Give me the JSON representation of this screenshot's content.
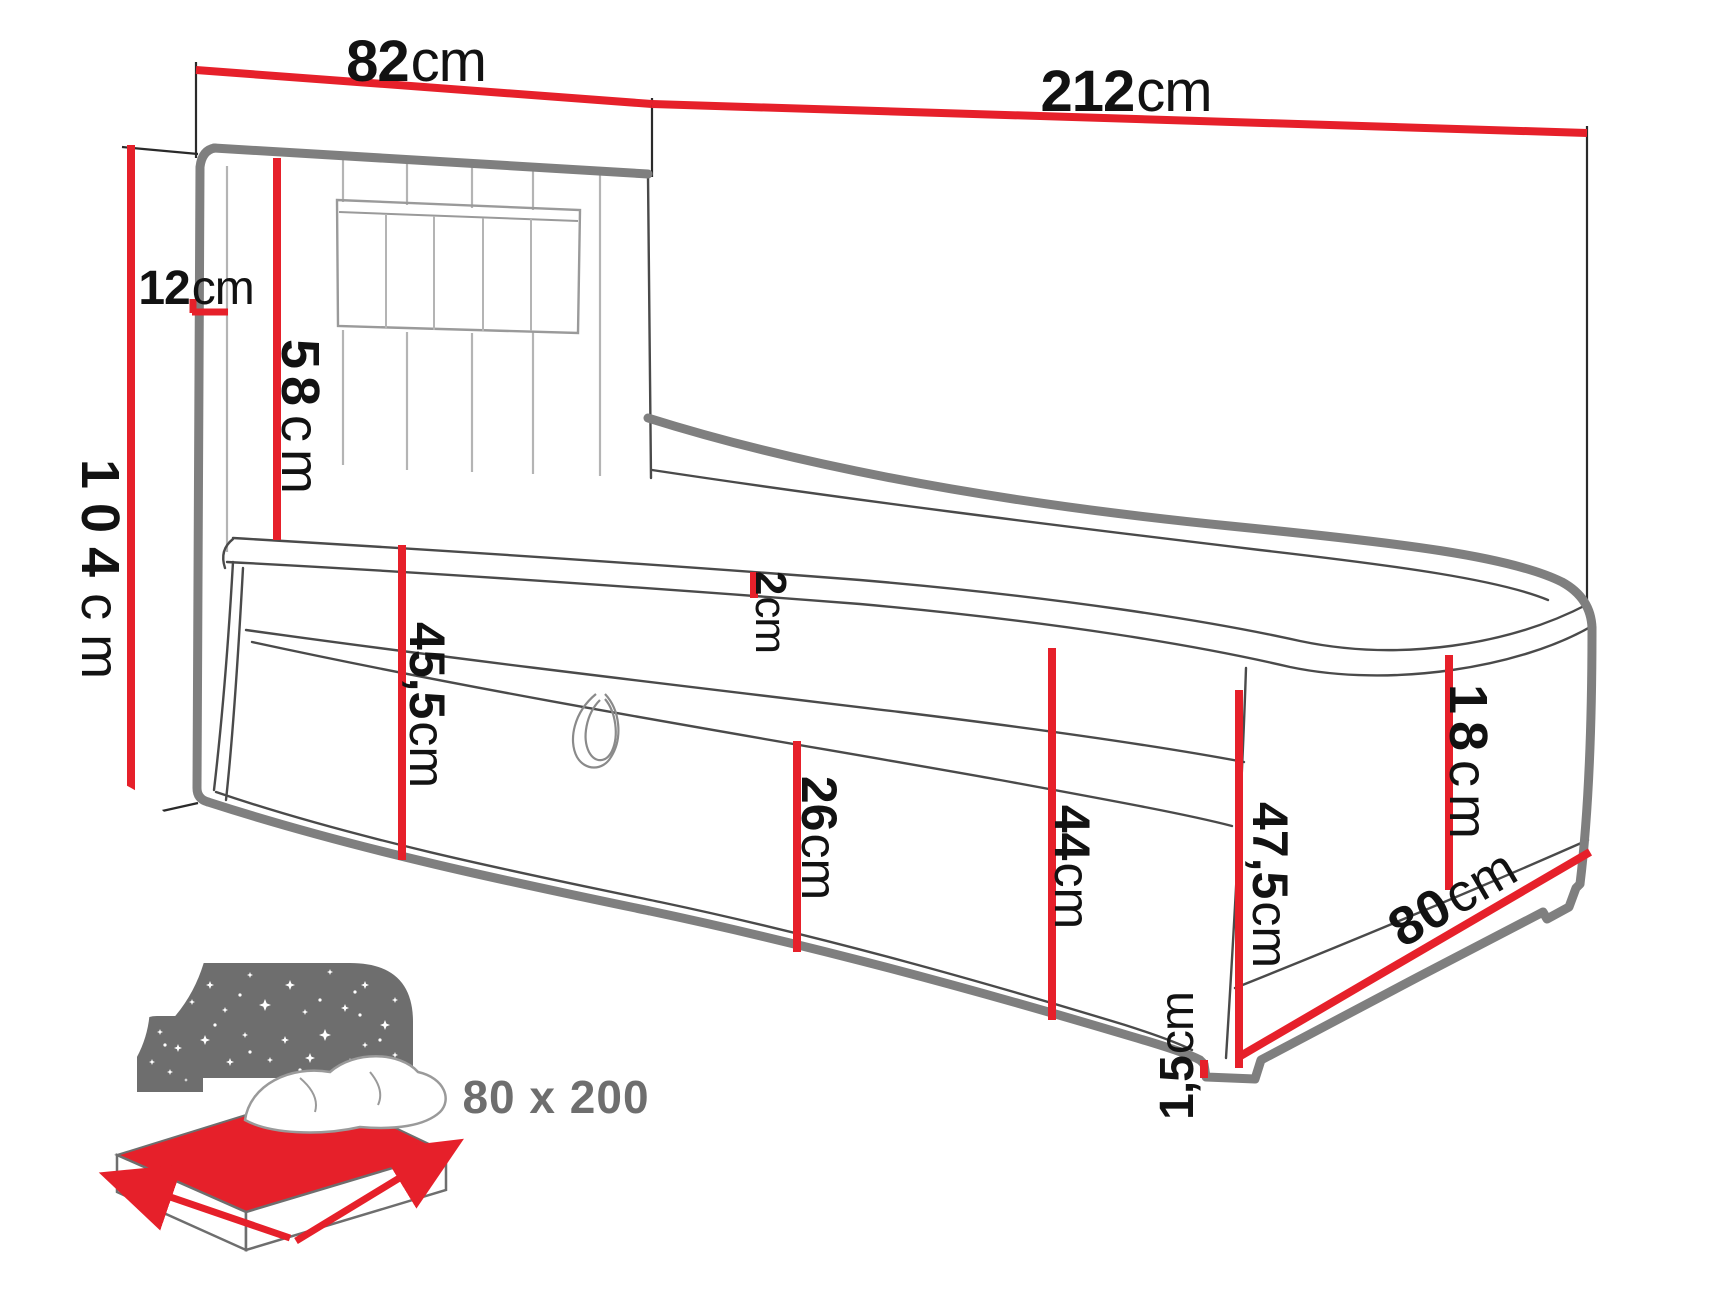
{
  "diagram_title": "boxspring-bed-dimension-diagram",
  "colors": {
    "dimension_red": "#e6202a",
    "outline_gray": "#7f7f7f",
    "detail_gray": "#4a4a4a",
    "seam_gray": "#b4b4b4",
    "icon_gray": "#6e6e6e",
    "text_black": "#121212"
  },
  "dimensions": {
    "headboard_width": {
      "value": "82",
      "unit": "cm"
    },
    "total_length": {
      "value": "212",
      "unit": "cm"
    },
    "total_height": {
      "value": "104",
      "unit": "cm"
    },
    "headboard_depth": {
      "value": "12",
      "unit": "cm"
    },
    "headboard_face_height": {
      "value": "58",
      "unit": "cm"
    },
    "mattress_lip": {
      "value": "2",
      "unit": "cm"
    },
    "side_height_head_end": {
      "value": "45,5",
      "unit": "cm"
    },
    "storage_box_height": {
      "value": "26",
      "unit": "cm"
    },
    "front_height_mid": {
      "value": "44",
      "unit": "cm"
    },
    "mattress_height": {
      "value": "18",
      "unit": "cm"
    },
    "foot_end_height": {
      "value": "47,5",
      "unit": "cm"
    },
    "bed_width": {
      "value": "80",
      "unit": "cm"
    },
    "leg_height": {
      "value": "1,5",
      "unit": "cm"
    }
  },
  "size_badge": {
    "label": "80 x 200"
  }
}
